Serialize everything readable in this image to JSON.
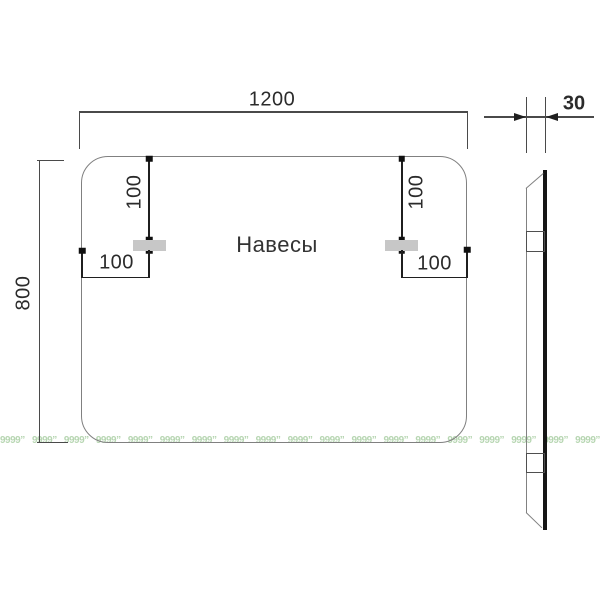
{
  "drawing": {
    "title": "Навесы",
    "dimensions": {
      "width": "1200",
      "height": "800",
      "depth": "30",
      "hanger_drop_left": "100",
      "hanger_drop_right": "100",
      "hanger_inset_left": "100",
      "hanger_inset_right": "100"
    },
    "colors": {
      "outline": "#808080",
      "dimension_line": "#4a4a4a",
      "dimension_dark": "#1f1f1f",
      "text": "#2b2b2b",
      "hanger_fill": "#c7c7c7",
      "side_panel": "#161616",
      "watermark": "#b7d6b2",
      "background": "#ffffff"
    }
  },
  "watermark": {
    "text": "9999”",
    "count": 19
  }
}
